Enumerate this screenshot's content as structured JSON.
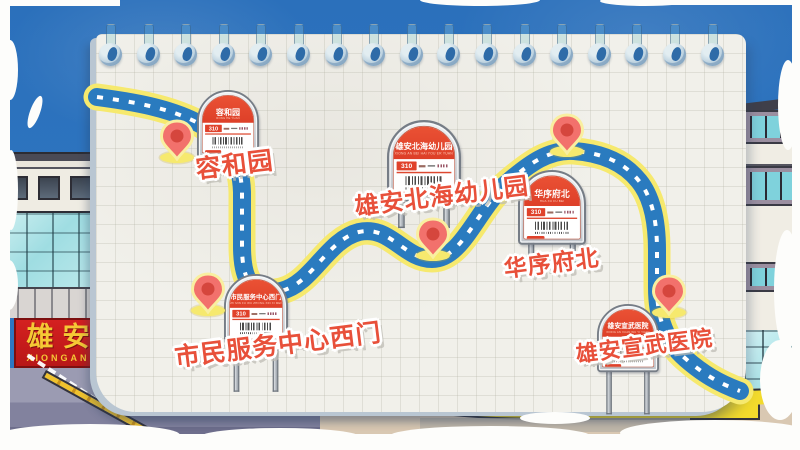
{
  "route": {
    "number": "310",
    "stops": [
      {
        "name": "容和园",
        "pinyin": "RONG HE YUAN"
      },
      {
        "name": "市民服务中心西门",
        "pinyin": "SHI MIN FU WU ZHONG XIN XI MEN"
      },
      {
        "name": "雄安北海幼儿园",
        "pinyin": "XIONG AN BEI HAI YOU ER YUAN"
      },
      {
        "name": "华序府北",
        "pinyin": "HUA XU FU BEI"
      },
      {
        "name": "雄安宣武医院",
        "pinyin": "XIONG AN XUAN WU YI YUAN"
      }
    ]
  },
  "landmark": {
    "cn": "雄安",
    "en": "XIONGAN"
  },
  "colors": {
    "sky_blue": "#2e77c0",
    "paper": "#f1f0ea",
    "road_blue": "#2a7bbf",
    "road_edge_yellow": "#f6e96e",
    "pin_coral": "#f2716c",
    "pin_inner_red": "#d5463d",
    "sign_red": "#e0422b",
    "label_red": "#e8503a",
    "landmark_red": "#c91c1c",
    "landmark_gold": "#f5c835"
  }
}
